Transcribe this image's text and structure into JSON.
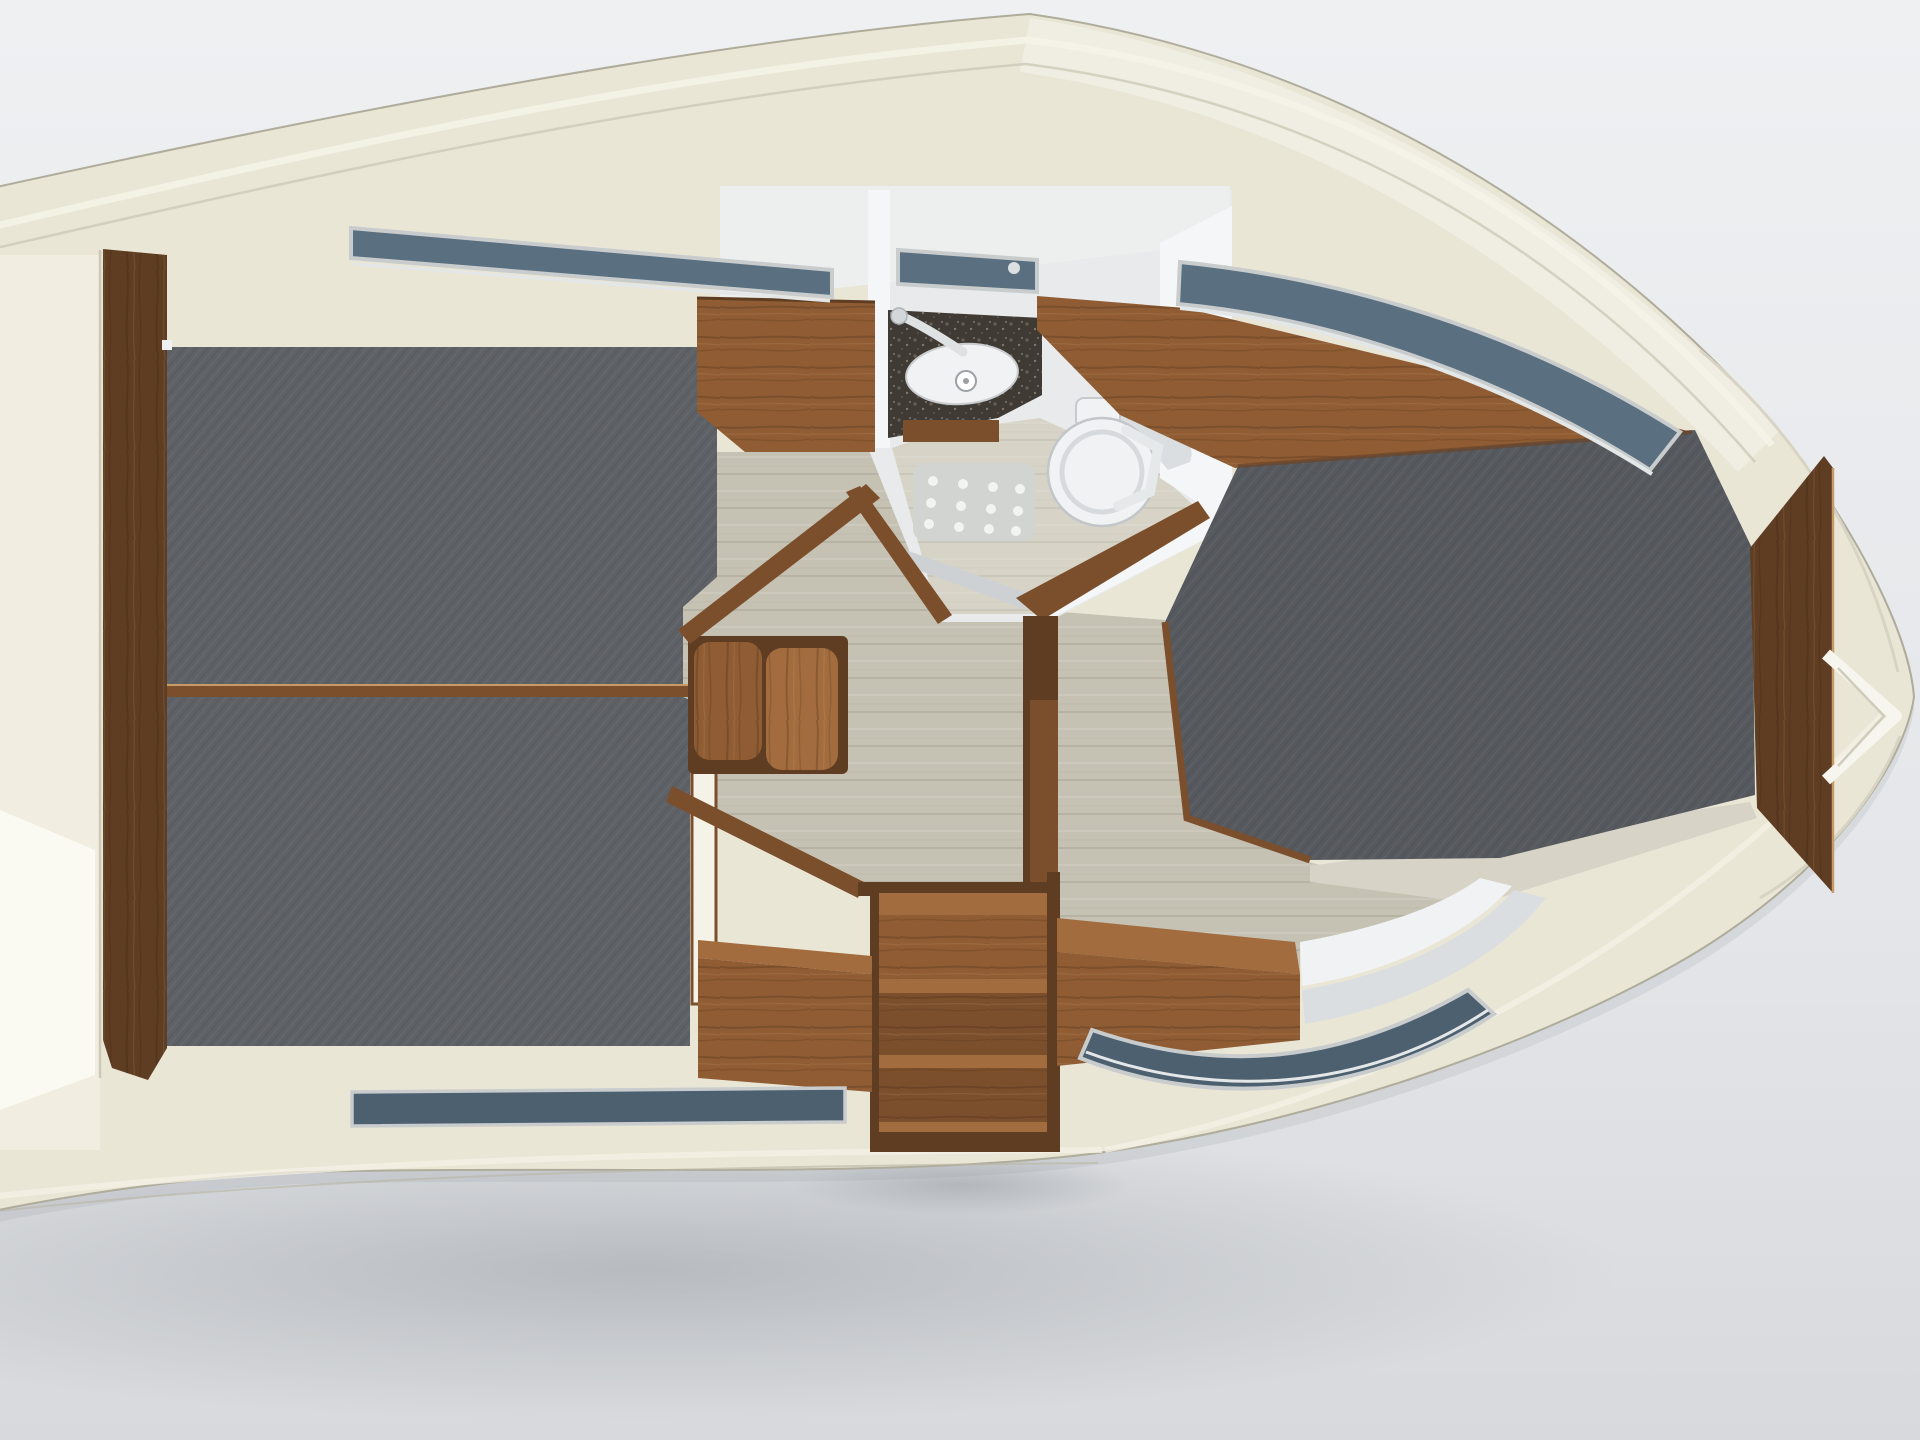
{
  "scene": {
    "description": "Top-down 3D rendering of a motor yacht lower-deck interior floor plan on a light gray studio backdrop",
    "view": "overhead cutaway, bow pointing right, stern running off the left edge",
    "text_visible": "none"
  },
  "colors": {
    "bg_top": "#eef0f2",
    "bg_bottom": "#d7d9dc",
    "hull": "#eae6d6",
    "hull_light": "#f5f2e7",
    "hull_dark": "#cdc9b8",
    "hull_edge": "#b0ac9c",
    "deck_white": "#edeeee",
    "wall_white": "#f5f6f7",
    "wall_light": "#e8eaeb",
    "berth_fabric": "#5e6166",
    "berth_fabric_dark": "#56595e",
    "wood_dark": "#5e3d23",
    "wood_mid": "#7c4f2c",
    "wood_warm": "#8f5c33",
    "wood_light": "#a26c3e",
    "floor_oak": "#c6c2b3",
    "floor_pale": "#d7d4c7",
    "glass_blue": "#5a6f7f",
    "glass_dark": "#4d6070",
    "window_frame": "#c9cccd",
    "chrome": "#dfe2e3",
    "counter_granite": "#3f3a34",
    "fixture_white": "#f1f2f3",
    "fixture_shadow": "#dbdee0",
    "shower_mat": "#d2d4d1",
    "threshold_steel": "#ced1d3",
    "shadow": "#9aa0a6"
  },
  "regions": [
    {
      "id": "hull",
      "label": "cream hull shell with deck seam lines"
    },
    {
      "id": "forward-cabin",
      "label": "left cabin: two gray fabric berths split by a wood divider, dark walnut side panel"
    },
    {
      "id": "head-compartment",
      "label": "center wet head: granite vanity with basin and faucet, round toilet, dotted shower mat"
    },
    {
      "id": "saloon",
      "label": "center oak sole with wooden seat bolsters and angled walnut door frames"
    },
    {
      "id": "companionway",
      "label": "wood entry steps protruding at bottom center"
    },
    {
      "id": "bow-cabin",
      "label": "right cabin: large gray island berth, walnut headboard band, tapered bow panel, white steps"
    },
    {
      "id": "windows",
      "label": "blue-gray hull window strips top-left, above head, top-right, bottom-left, bottom-right"
    }
  ]
}
